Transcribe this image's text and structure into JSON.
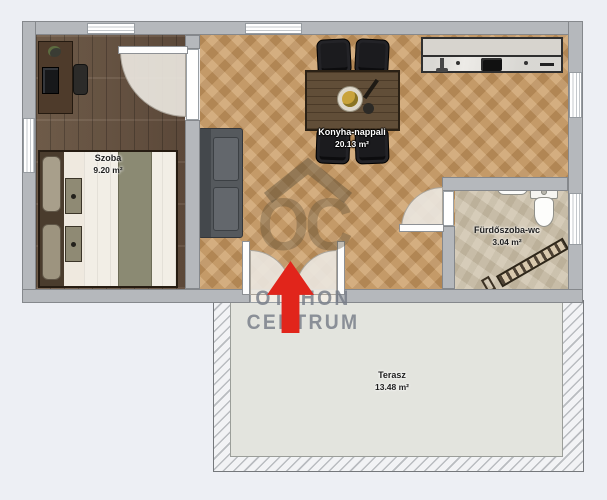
{
  "rooms": [
    {
      "name": "Szoba",
      "area": "9.20 m²"
    },
    {
      "name": "Konyha-nappali",
      "area": "20.13 m²"
    },
    {
      "name": "Fürdőszoba-wc",
      "area": "3.04 m²"
    },
    {
      "name": "Terasz",
      "area": "13.48 m²"
    }
  ],
  "watermark": {
    "logo": "OC",
    "line1": "OTTHON",
    "line2": "CENTRUM"
  },
  "entrance": {
    "marker": "arrow-up"
  },
  "colors": {
    "arrow_red": "#e1251b",
    "wall_gray": "#b5b8bc",
    "bedroom_floor": "#6b5544",
    "living_floor": "#c99a63",
    "bathroom_floor": "#ccc0a9",
    "terrace_deck": "#e3e4de",
    "watermark_text": "#767d88",
    "watermark_logo": "#5e5140",
    "background": "#edeff4"
  }
}
